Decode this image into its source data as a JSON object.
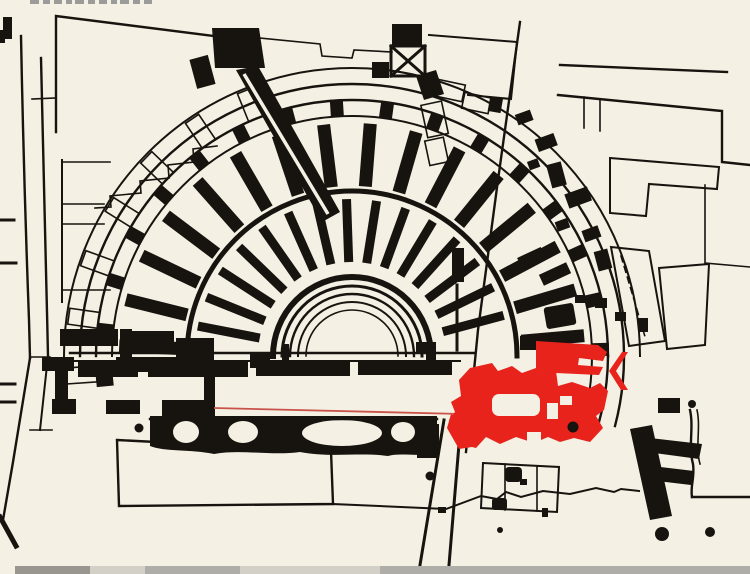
{
  "figure": {
    "kind": "scanned-archaeological-site-plan",
    "subject": "semicircular-theatre-plan-with-city-blocks",
    "caption_fragment": {
      "position": "top-left",
      "legible": false,
      "style": "small gray text cropped by image edge"
    },
    "highlight": {
      "color": "#e8231c",
      "shape": "later-building-plan-overlay",
      "reference_line_color": "#c9534a"
    },
    "theatre": {
      "orchestra_concentric_arcs": 5,
      "inner_radial_walls": 15,
      "outer_radial_walls": 16,
      "outer_ring_pilaster_blocks": 18,
      "outlined_outer_blocks_left": 7
    },
    "scan_artifacts": {
      "bottom_edge_strip": true,
      "strip_colors": [
        "#98968f",
        "#afada8",
        "#d3d0c8"
      ]
    }
  },
  "colors": {
    "paper": "#f4f0e3",
    "ink": "#17130f",
    "highlight_red": "#e8231c",
    "red_line": "#c9534a",
    "caption_gray": "#9b9b99",
    "strip": "#afada8",
    "strip_light": "#d3d0c8",
    "strip_dark": "#98968f"
  }
}
